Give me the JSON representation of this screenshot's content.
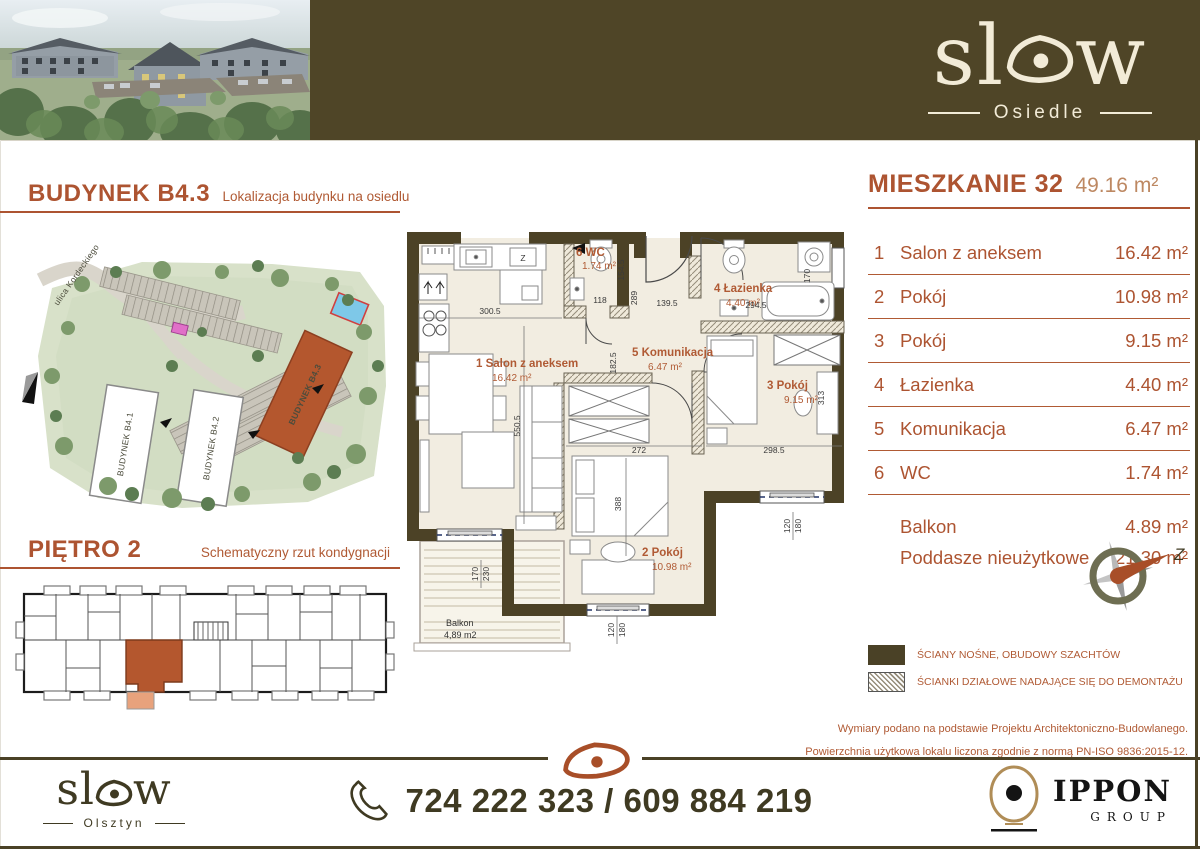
{
  "colors": {
    "rust": "#ad5431",
    "rust_light": "#bd8862",
    "olive": "#4a4126",
    "cream": "#f2ece0",
    "banner": "#4f4527"
  },
  "banner": {
    "logo_left": "sl",
    "logo_right": "w",
    "logo_sub": "Osiedle"
  },
  "left": {
    "building_title": "BUDYNEK B4.3",
    "building_subtitle": "Lokalizacja budynku na osiedlu",
    "floor_title": "PIĘTRO 2",
    "floor_subtitle": "Schematyczny rzut kondygnacji",
    "site_map": {
      "street": "ulica Kordeckiego",
      "b1": "BUDYNEK B4.1",
      "b2": "BUDYNEK B4.2",
      "b3": "BUDYNEK B4.3"
    }
  },
  "plan": {
    "labels": {
      "salon": {
        "t": "1  Salon z aneksem",
        "a": "16.42 m²"
      },
      "wc": {
        "t": "6  WC",
        "a": "1.74 m²"
      },
      "bath": {
        "t": "4  Łazienka",
        "a": "4.40 m²"
      },
      "hall": {
        "t": "5  Komunikacja",
        "a": "6.47 m²"
      },
      "room3": {
        "t": "3  Pokój",
        "a": "9.15 m²"
      },
      "room2": {
        "t": "2  Pokój",
        "a": "10.98 m²"
      },
      "balcony": {
        "t": "Balkon",
        "a": "4,89 m2"
      },
      "kitchen_z": "Z"
    },
    "dims": {
      "k300": "300.5",
      "k550": "550.5",
      "k118": "118",
      "k154": "154.5",
      "k289": "289",
      "k139": "139.5",
      "k294": "294.5",
      "k170b": "170",
      "k182": "182.5",
      "k272": "272",
      "k298": "298.5",
      "k313": "313",
      "k388": "388",
      "k170": "170",
      "k230": "230",
      "k120": "120",
      "k180": "180"
    }
  },
  "unit": {
    "title": "MIESZKANIE 32",
    "total_area": "49.16 m²",
    "rooms": [
      {
        "num": "1",
        "name": "Salon z aneksem",
        "area": "16.42 m²"
      },
      {
        "num": "2",
        "name": "Pokój",
        "area": "10.98 m²"
      },
      {
        "num": "3",
        "name": "Pokój",
        "area": "9.15 m²"
      },
      {
        "num": "4",
        "name": "Łazienka",
        "area": "4.40 m²"
      },
      {
        "num": "5",
        "name": "Komunikacja",
        "area": "6.47 m²"
      },
      {
        "num": "6",
        "name": "WC",
        "area": "1.74 m²"
      }
    ],
    "extras": [
      {
        "name": "Balkon",
        "area": "4.89 m²"
      },
      {
        "name": "Poddasze nieużytkowe",
        "area": "21.30 m²"
      }
    ],
    "compass_label": "Z",
    "legend": [
      {
        "type": "solid",
        "label": "ŚCIANY NOŚNE, OBUDOWY SZACHTÓW"
      },
      {
        "type": "hatch",
        "label": "ŚCIANKI DZIAŁOWE NADAJĄCE SIĘ DO DEMONTAŻU"
      }
    ],
    "disclaimer": [
      "Wymiary podano na podstawie Projektu Architektoniczno-Budowlanego.",
      "Powierzchnia użytkowa lokalu liczona zgodnie z normą PN-ISO 9836:2015-12."
    ]
  },
  "footer": {
    "logo_left": "sl",
    "logo_right": "w",
    "city": "Olsztyn",
    "phone": "724 222 323 / 609 884 219",
    "partner": "IPPON",
    "partner_sub": "GROUP"
  }
}
